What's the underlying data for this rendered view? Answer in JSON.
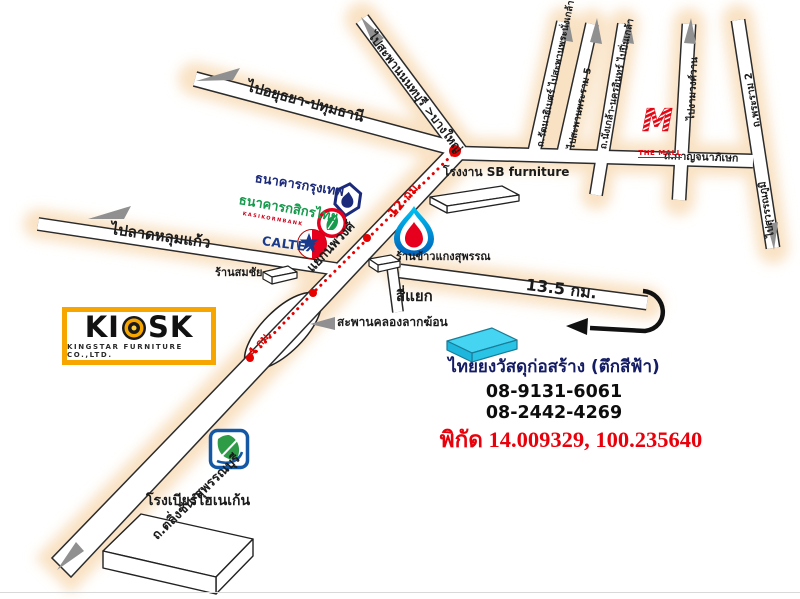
{
  "roads": {
    "to_ayutthaya": "ไปอยุธยา-ปทุมธานี",
    "to_nonthaburi_bridge": "ไปสะพานนนทบุรี >บางใหญ่",
    "kanchanaphisek": "ถ.กาญจนาภิเษก",
    "rattanathibet": "ถ.รัตนาธิเบศร์ ไปสะพานพระนั่งเกล้า",
    "to_rama5_bridge": "ไปสะพานพระราม 5",
    "nakhon_in": "ถ.นั่งเกล้า-นครอินทร์ ไปปิ่นเกล้า",
    "to_ngamwongwan": "ไปงามวงศ์วาน",
    "rama2": "ถ.พระราม 2",
    "to_suvarnabhumi": "ไปสุวรรณภูมิ",
    "to_lat_lum_kaeo": "ไปลาดหลุมแก้ว",
    "taling_chan_suphanburi": "ถ.ตลิ่งชัน-สุพรรณบุรี",
    "nopphawong_junction": "แยกนพวงศ์",
    "crossroads": "สี่แยก",
    "lak_khon_bridge": "สะพานคลองลากฆ้อน"
  },
  "distances": {
    "route_12km": "12 กม.",
    "route_4km": "4 กม.",
    "road_13_5km": "13.5 กม."
  },
  "landmarks": {
    "sb_factory": "โรงงาน SB furniture",
    "rice_shop": "ร้านข้าวแกงสุพรรณ",
    "somchai_shop": "ร้านสมชัย",
    "heineken_brewery": "โรงเบียร์ไฮเนเก้น",
    "the_mall": "THE MALL",
    "the_mall_monogram": "M"
  },
  "brands": {
    "bangkok_bank": "ธนาคารกรุงเทพ",
    "kasikorn_bank": "ธนาคารกสิกรไทย",
    "kasikorn_sub": "KASIKORNBANK",
    "caltex": "CALTEX",
    "kiosk_left": "KI",
    "kiosk_right": "SK",
    "kiosk_subtitle": "KINGSTAR FURNITURE CO.,LTD."
  },
  "destination": {
    "name": "ไทยยงวัสดุก่อสร้าง (ตึกสีฟ้า)",
    "phone1": "08-9131-6061",
    "phone2": "08-2442-4269",
    "coordinates": "พิกัด 14.009329, 100.235640"
  },
  "colors": {
    "route_red": "#e60000",
    "coordinates_red": "#e8000b",
    "bangkok_bank_navy": "#1b2a7a",
    "kasikorn_green": "#169a4c",
    "caltex_blue": "#1a3a8c",
    "mall_red": "#e30613",
    "kiosk_orange": "#f7a600",
    "blue_building_cyan": "#45d4f2",
    "bangchak_blue": "#1458a5",
    "bangchak_green": "#2e9b47",
    "road_glow": "#f9e2c4"
  }
}
